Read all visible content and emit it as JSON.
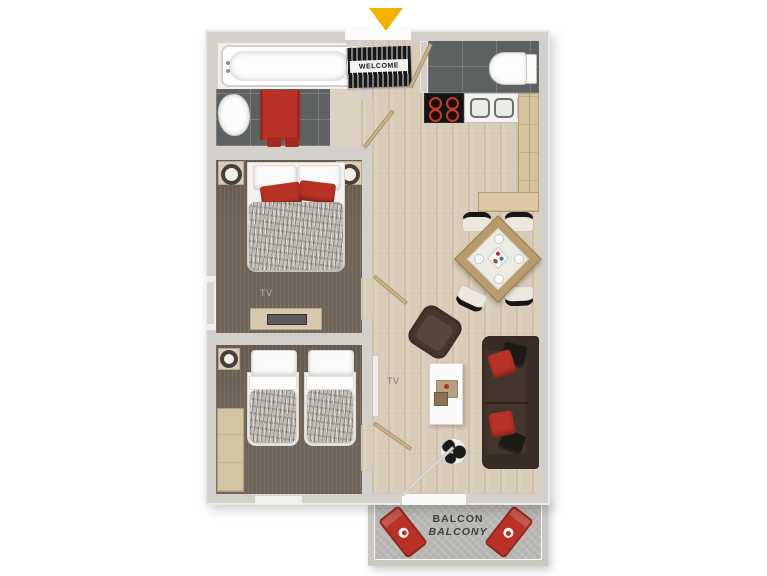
{
  "labels": {
    "welcome_mat": "WELCOME",
    "bedroom_tv": "TV",
    "living_tv": "TV",
    "balcony_line1": "BALCON",
    "balcony_line2": "BALCONY"
  },
  "icons": {
    "entrance_arrow": "down-triangle"
  },
  "colors": {
    "accent_red": "#b83227",
    "arrow_yellow": "#f5b301",
    "wall_grey": "#d3cfca",
    "wood_floor": "#d9ccb8",
    "dark_bedroom_floor": "#6f6459",
    "dark_tile": "#5e6162",
    "sofa_brown": "#43352e",
    "balcony_concrete": "#b9b7b3"
  }
}
